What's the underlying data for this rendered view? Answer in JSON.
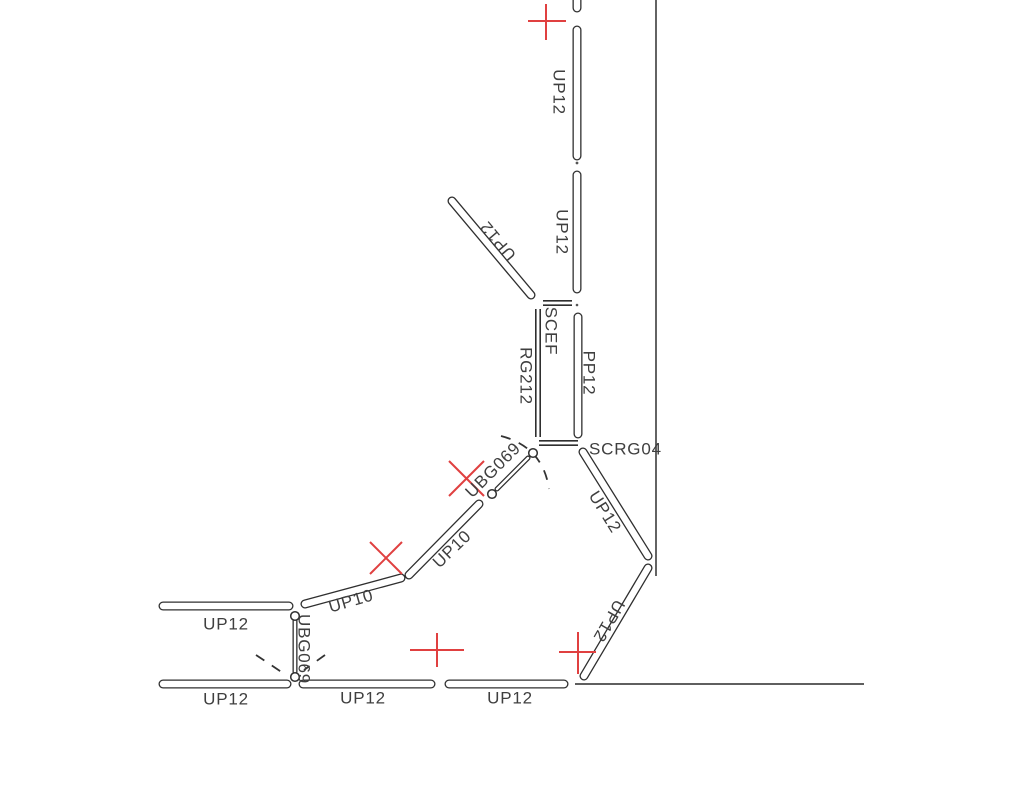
{
  "drawing": {
    "colors": {
      "background": "#ffffff",
      "line": "#2f2f2f",
      "text": "#3f3f3f",
      "red": "#e04040"
    },
    "labels": [
      {
        "id": "up12-riser-top",
        "text": "UP12"
      },
      {
        "id": "up12-riser-mid",
        "text": "UP12"
      },
      {
        "id": "up12-branch-upper-left",
        "text": "UP12"
      },
      {
        "id": "scef",
        "text": "SCEF"
      },
      {
        "id": "rg212",
        "text": "RG212"
      },
      {
        "id": "pp12",
        "text": "PP12"
      },
      {
        "id": "scrg04",
        "text": "SCRG04"
      },
      {
        "id": "ubg069-diagonal",
        "text": "UBG069"
      },
      {
        "id": "up12-diagonal-right",
        "text": "UP12"
      },
      {
        "id": "up10-upper",
        "text": "UP10"
      },
      {
        "id": "up10-lower",
        "text": "UP10"
      },
      {
        "id": "up12-left-top",
        "text": "UP12"
      },
      {
        "id": "ubg069-vertical",
        "text": "UBG069"
      },
      {
        "id": "up12-left-bottom",
        "text": "UP12"
      },
      {
        "id": "up12-bottom-middle",
        "text": "UP12"
      },
      {
        "id": "up12-bottom-right",
        "text": "UP12"
      },
      {
        "id": "up12-diagonal-bottom",
        "text": "UP12"
      }
    ],
    "markers": {
      "cross_count": 3,
      "x_count": 2,
      "color": "#e04040"
    }
  }
}
